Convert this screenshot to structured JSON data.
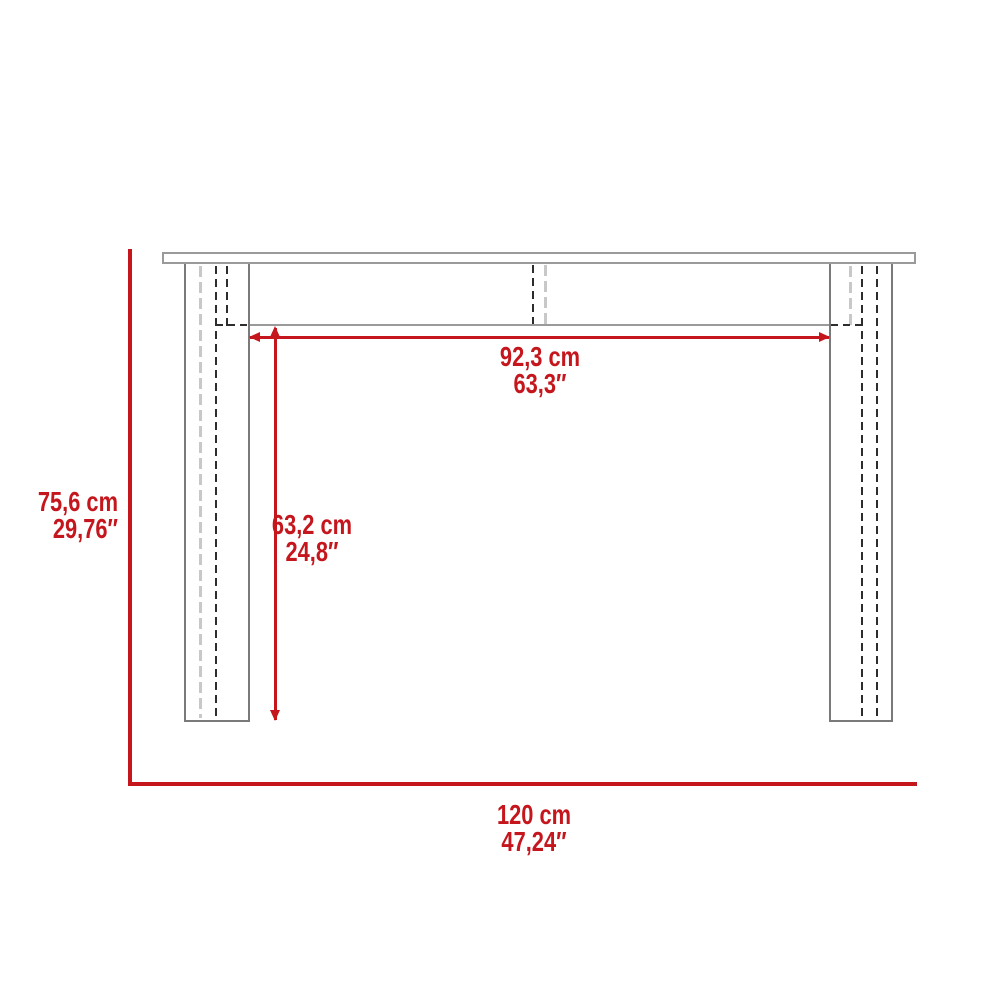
{
  "diagram": {
    "type": "furniture-dimension-drawing",
    "subject": "console table front elevation",
    "labels": {
      "inner_width": {
        "metric": "92,3 cm",
        "imperial": "63,3″"
      },
      "leg_height": {
        "metric": "63,2 cm",
        "imperial": "24,8″"
      },
      "overall_height": {
        "metric": "75,6 cm",
        "imperial": "29,76″"
      },
      "overall_width": {
        "metric": "120 cm",
        "imperial": "47,24″"
      }
    }
  },
  "colors": {
    "accent_red": "#c4161c",
    "outline_gray": "#9a9a9a",
    "leg_gray": "#7a7a7a",
    "hidden_line_black": "#2d2d2d",
    "hidden_line_light": "#c8c8c8",
    "background": "#ffffff"
  }
}
